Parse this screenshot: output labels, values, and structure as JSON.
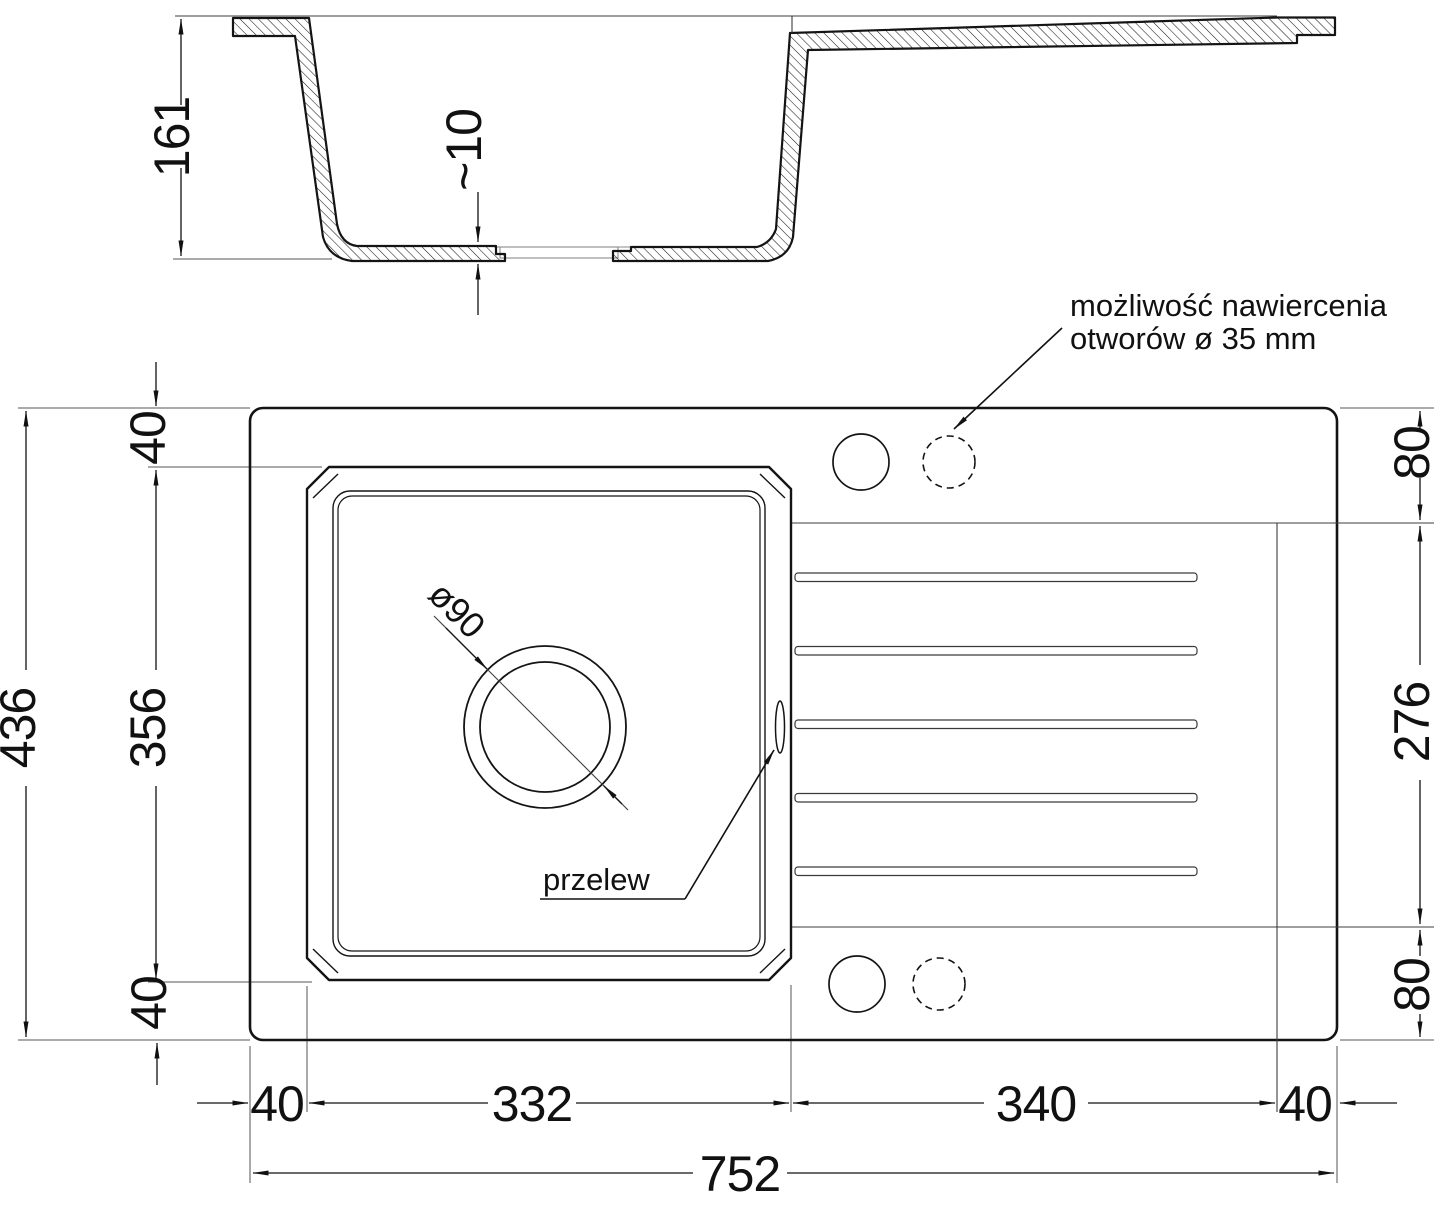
{
  "drawing": {
    "type": "kitchen sink technical drawing",
    "section": {
      "depth": "161",
      "bottom_thickness": "~10"
    },
    "plan": {
      "total_width": "752",
      "total_height": "436",
      "left_rim": "40",
      "bowl_width": "332",
      "drainer_width": "340",
      "right_rim": "40",
      "top_rim": "40",
      "bowl_height": "356",
      "bottom_rim": "40",
      "right_top": "80",
      "right_middle": "276",
      "right_bottom": "80",
      "drain_diameter": "ø90",
      "overflow_label": "przelew",
      "note_line1": "możliwość nawiercenia",
      "note_line2": "otworów ø 35 mm"
    },
    "colors": {
      "line": "#111111",
      "background": "#ffffff"
    }
  }
}
